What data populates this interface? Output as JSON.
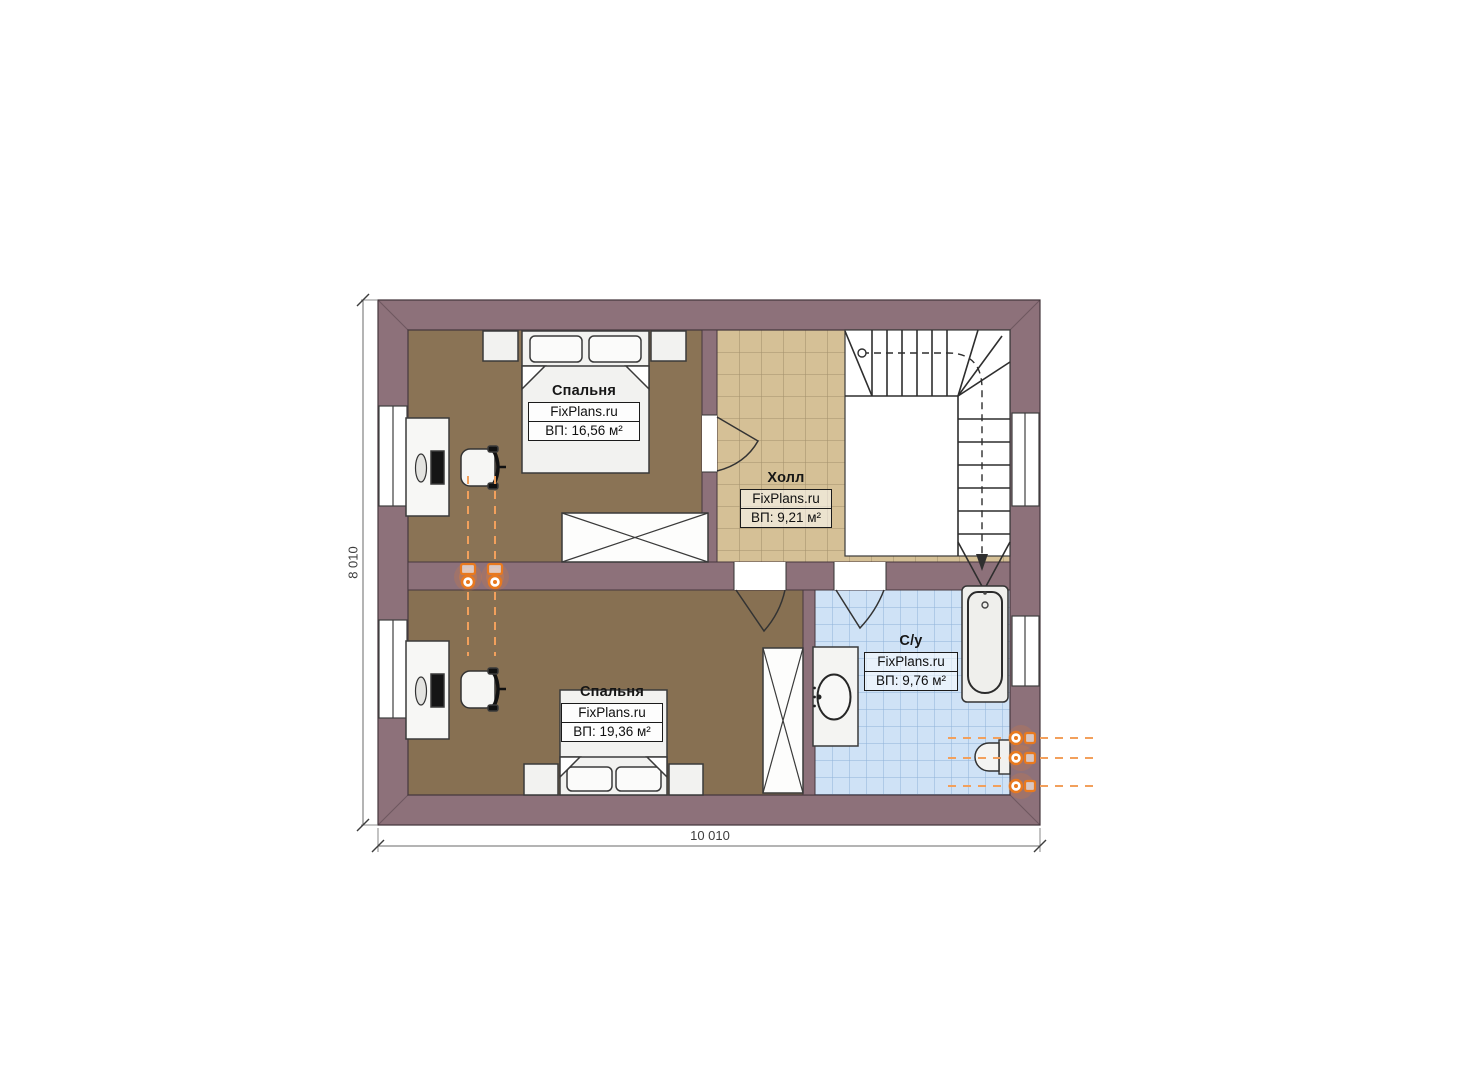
{
  "plan": {
    "rooms": [
      {
        "name": "Спальня",
        "brand": "FixPlans.ru",
        "area": "ВП: 16,56 м²"
      },
      {
        "name": "Холл",
        "brand": "FixPlans.ru",
        "area": "ВП: 9,21 м²"
      },
      {
        "name": "Спальня",
        "brand": "FixPlans.ru",
        "area": "ВП: 19,36 м²"
      },
      {
        "name": "С/у",
        "brand": "FixPlans.ru",
        "area": "ВП: 9,76 м²"
      }
    ],
    "dimensions": {
      "height_label": "8 010",
      "width_label": "10 010"
    },
    "colors": {
      "wall": "#8d717a",
      "bedroom_floor": "#8a7355",
      "hall_tile": "#d5c096",
      "hall_grout": "#a3906c",
      "bath_tile": "#cfe2f6",
      "bath_grout": "#8fb2d8",
      "pipe_orange": "#e8791f",
      "outline": "#3a3a3a"
    },
    "symbols": [
      "stairs-symbol",
      "double-bed-symbol",
      "wardrobe-cross-symbol",
      "bathtub-symbol",
      "toilet-symbol",
      "sink-vanity-symbol",
      "desk-computer-symbol",
      "office-chair-symbol",
      "heating-riser-symbol",
      "window-symbol",
      "door-swing-symbol"
    ]
  }
}
